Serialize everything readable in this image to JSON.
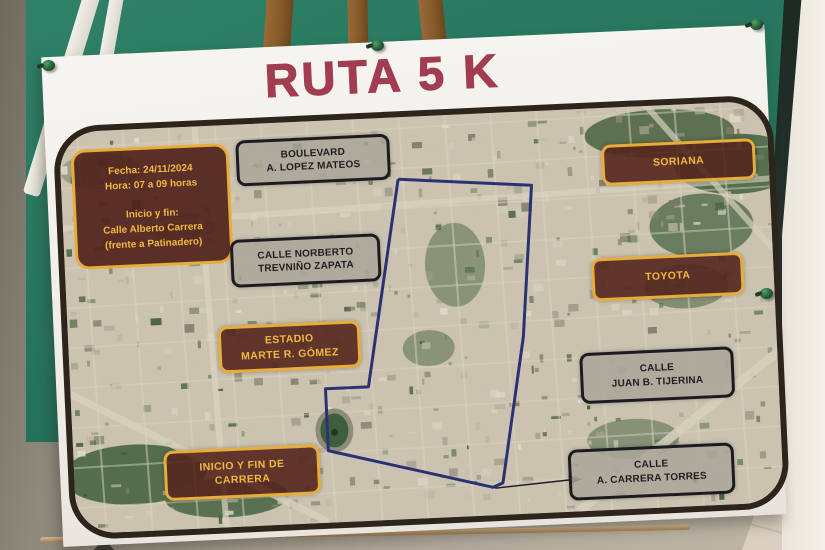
{
  "poster": {
    "title": "RUTA 5 K",
    "info_box": {
      "line1": "Fecha: 24/11/2024",
      "line2": "Hora: 07 a 09 horas",
      "line3": "Inicio y fin:",
      "line4": "Calle Alberto Carrera",
      "line5": "(frente a Patinadero)"
    },
    "labels": {
      "boulevard": {
        "line1": "BOULEVARD",
        "line2": "A. LOPEZ MATEOS"
      },
      "soriana": {
        "line1": "SORIANA"
      },
      "norberto": {
        "line1": "CALLE NORBERTO",
        "line2": "TREVNIÑO ZAPATA"
      },
      "toyota": {
        "line1": "TOYOTA"
      },
      "estadio": {
        "line1": "ESTADIO",
        "line2": "MARTE R. GÓMEZ"
      },
      "tijerina": {
        "line1": "CALLE",
        "line2": "JUAN B. TIJERINA"
      },
      "inicio": {
        "line1": "INICIO Y FIN DE",
        "line2": "CARRERA"
      },
      "torres": {
        "line1": "CALLE",
        "line2": "A. CARRERA TORRES"
      }
    }
  },
  "map": {
    "route_points": "337,62 470,74 455,225 428,370 418,374 255,330 255,268 298,268 337,62",
    "route_color": "#2b3272"
  },
  "icons": {
    "pushpin": "pushpin-icon",
    "route_arrow": "arrow-right-icon"
  },
  "colors": {
    "title_red": "#a23c50",
    "board_green": "#27755e",
    "landmark_bg": "#54261d",
    "landmark_gold": "#e8ac3a",
    "street_gray": "#aaa699",
    "map_border": "#2d241b"
  }
}
